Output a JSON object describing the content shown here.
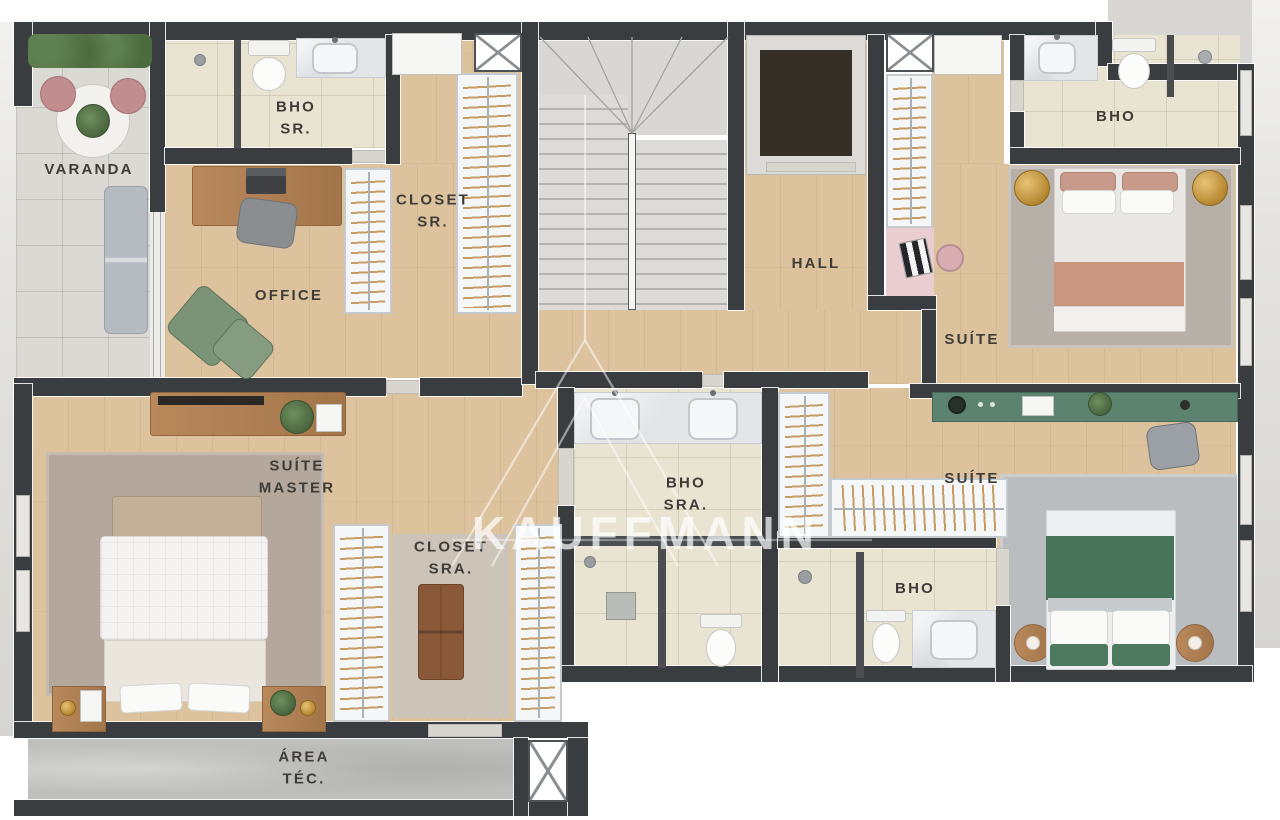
{
  "watermark": {
    "brand": "KAUFFMANN"
  },
  "rooms": {
    "varanda": "VARANDA",
    "bho_sr": "BHO\nSR.",
    "closet_sr": "CLOSET\nSR.",
    "office": "OFFICE",
    "hall": "HALL",
    "bho_suite_top": "BHO",
    "suite_top": "SUÍTE",
    "suite_master": "SUÍTE\nMASTER",
    "closet_sra": "CLOSET\nSRA.",
    "bho_sra": "BHO\nSRA.",
    "bho_suite_bottom": "BHO",
    "suite_bottom": "SUÍTE",
    "area_tec": "ÁREA\nTÉC."
  },
  "colors": {
    "wall": "#3a3d40",
    "wood_floor": "#dcc39e",
    "tile_floor": "#e9e3d2",
    "concrete": "#bfc0be",
    "accent_peach": "#cb9680",
    "accent_green_bed": "#48745a",
    "accent_green_console": "#5c8370",
    "accent_pink": "#e9cdd0",
    "gold": "#c79a42",
    "label_text": "#3f3c38"
  }
}
